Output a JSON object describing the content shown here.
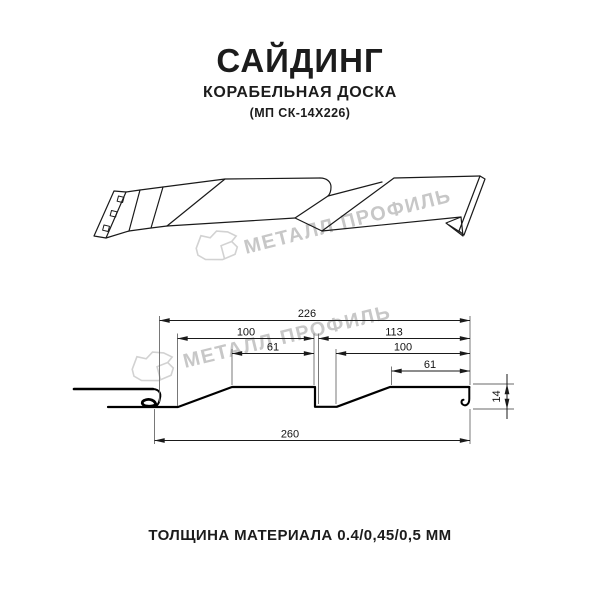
{
  "header": {
    "title": "САЙДИНГ",
    "subtitle": "КОРАБЕЛЬНАЯ ДОСКА",
    "model": "(МП СК-14Х226)"
  },
  "footer": {
    "text": "ТОЛЩИНА МАТЕРИАЛА 0.4/0,45/0,5 ММ"
  },
  "watermark": {
    "text": "МЕТАЛЛ ПРОФИЛЬ",
    "text_color": "#c7c7c7",
    "logo_color": "#d2d2d2"
  },
  "drawing": {
    "line_color": "#1a1a1a",
    "dim_labels": {
      "overall_top": "226",
      "left_plank": "100",
      "right_section": "113",
      "left_face": "61",
      "right_plank": "100",
      "right_face": "61",
      "total_bottom": "260",
      "profile_height": "14"
    }
  }
}
